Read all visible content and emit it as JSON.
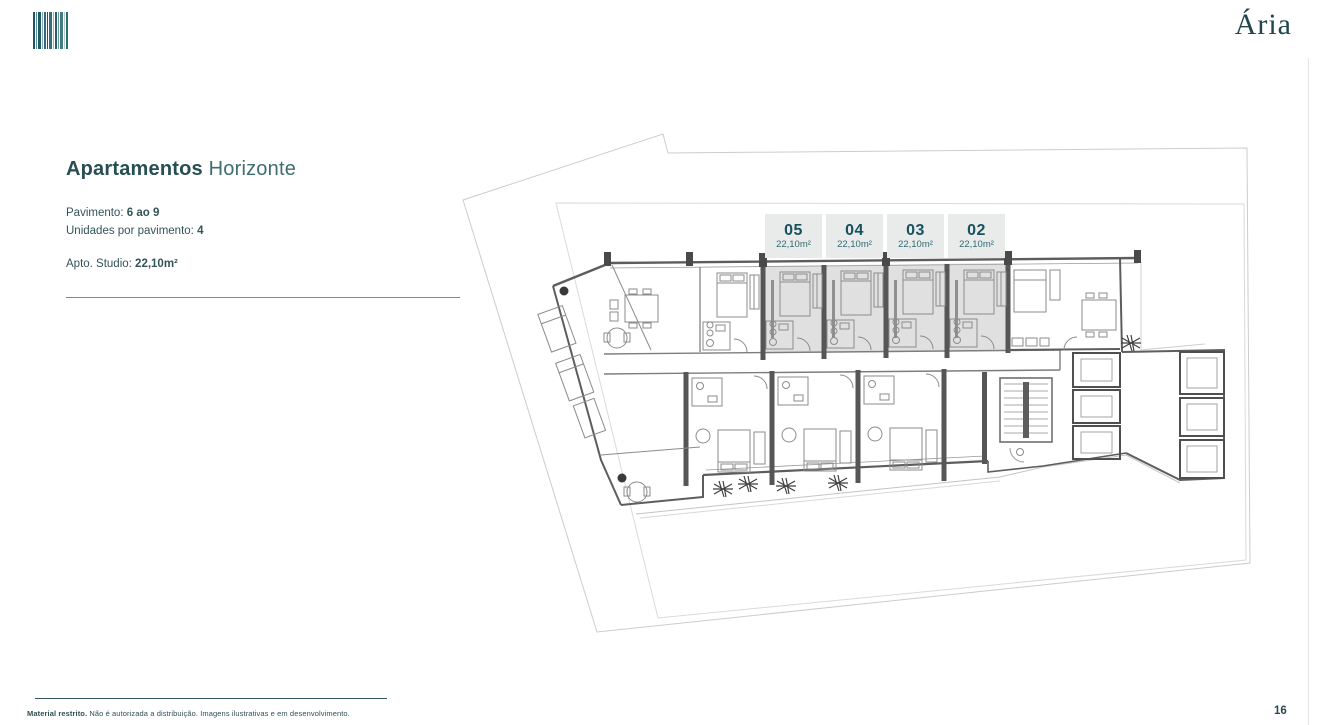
{
  "brand": {
    "wordmark": "Ária",
    "logo_icon": "barcode-icon",
    "colors": {
      "primary_teal": "#1d515c",
      "secondary_teal": "#45737b",
      "label_box_bg": "#e9ebeb",
      "highlight_gray": "#d9d9d9"
    }
  },
  "title": {
    "bold": "Apartamentos",
    "regular": " Horizonte"
  },
  "specs": [
    {
      "label": "Pavimento: ",
      "value": "6 ao 9"
    },
    {
      "label": "Unidades por pavimento: ",
      "value": "4"
    },
    {
      "label": "Apto. Studio: ",
      "value": "22,10m²"
    }
  ],
  "floorplan": {
    "units": [
      {
        "number": "05",
        "area": "22,10m²"
      },
      {
        "number": "04",
        "area": "22,10m²"
      },
      {
        "number": "03",
        "area": "22,10m²"
      },
      {
        "number": "02",
        "area": "22,10m²"
      }
    ]
  },
  "footer": {
    "restricted": "Material restrito.",
    "disclaimer": " Não é autorizada a distribuição. Imagens ilustrativas e em desenvolvimento."
  },
  "page": {
    "number": "16"
  }
}
